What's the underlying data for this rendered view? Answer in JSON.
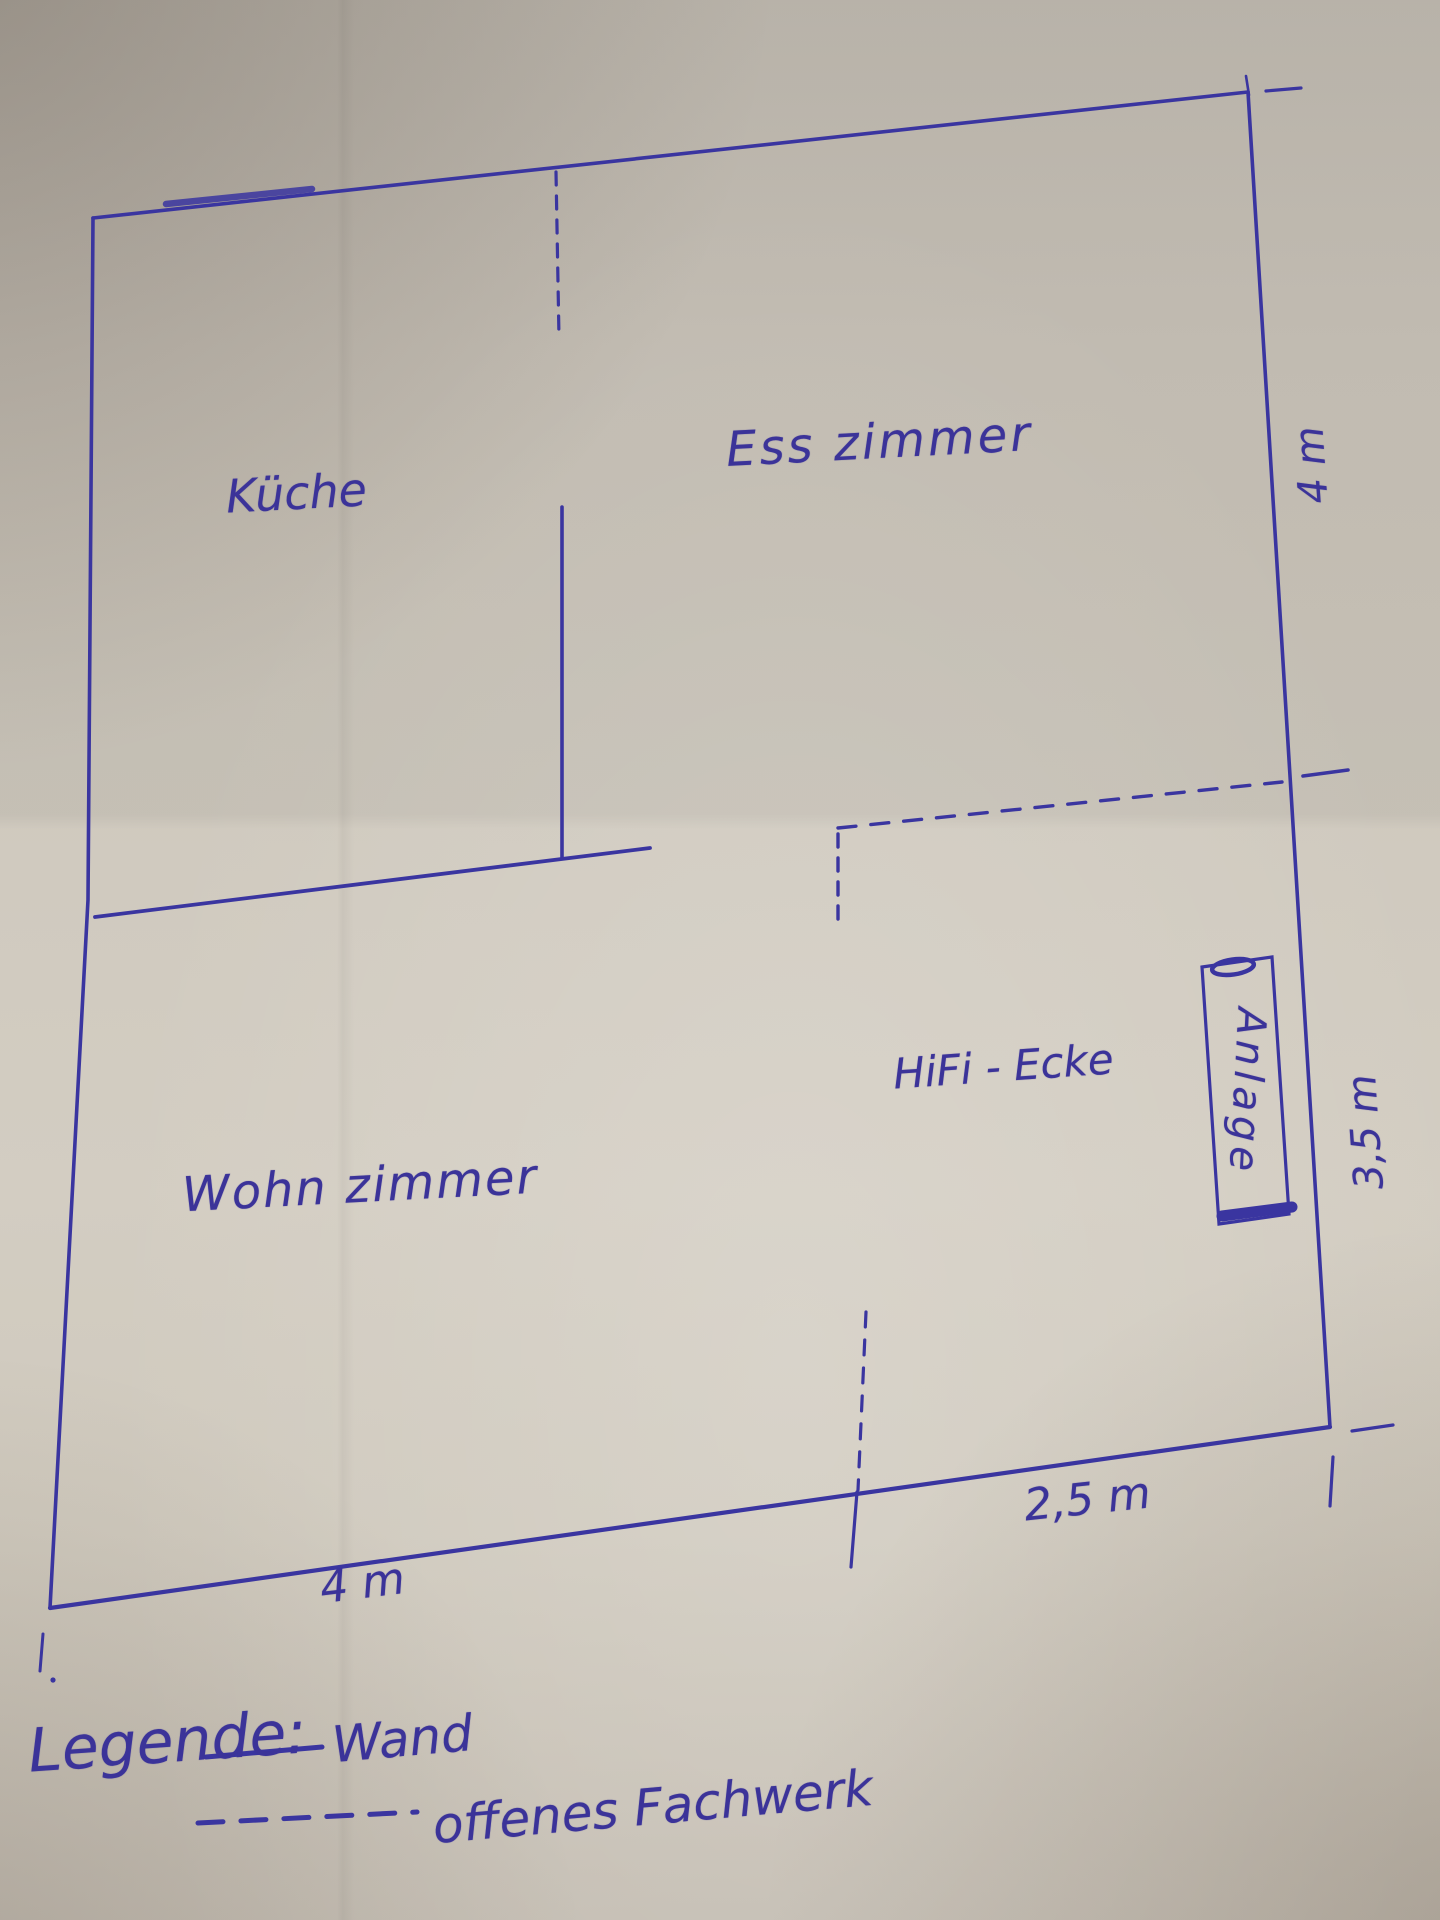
{
  "floorplan": {
    "paper_color": "#cfc9be",
    "ink_color": "#3b3399",
    "rooms": [
      {
        "name": "kueche",
        "label": "Küche"
      },
      {
        "name": "esszimmer",
        "label": "Ess zimmer"
      },
      {
        "name": "wohnzimmer",
        "label": "Wohn zimmer"
      },
      {
        "name": "hifi-ecke",
        "label": "HiFi - Ecke"
      },
      {
        "name": "anlage",
        "label": "Anlage"
      }
    ],
    "dimensions": [
      {
        "name": "right-upper-wall",
        "label": "4 m"
      },
      {
        "name": "right-lower-wall",
        "label": "3,5 m"
      },
      {
        "name": "bottom-right-wall",
        "label": "2,5 m"
      },
      {
        "name": "bottom-left-wall",
        "label": "4 m"
      }
    ],
    "legend": {
      "heading": "Legende:",
      "items": [
        {
          "symbol": "solid-line",
          "label": "Wand"
        },
        {
          "symbol": "dashed-line",
          "label": "offenes Fachwerk"
        }
      ]
    }
  }
}
